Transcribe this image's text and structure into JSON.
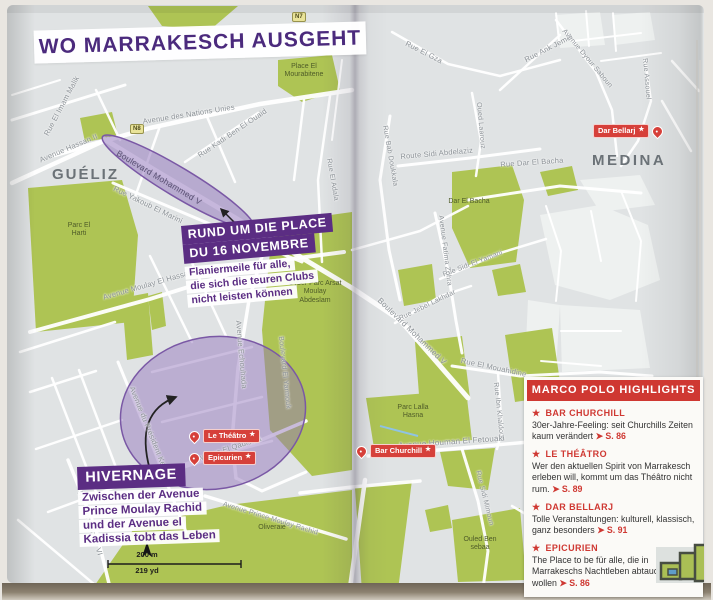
{
  "title": "WO MARRAKESCH AUSGEHT",
  "icons": {
    "star": "★",
    "page_arrow": "➤"
  },
  "road_badges": {
    "n7": "N7",
    "n8": "N8"
  },
  "districts": {
    "gueliz": "GUÉLIZ",
    "medina": "MEDINA"
  },
  "colors": {
    "accent_purple": "#5b2d83",
    "title_purple": "#4b2a7d",
    "accent_red": "#cf3832",
    "marker_red": "#d6403a",
    "map_green": "#aec454",
    "highlight_area_purple": "#9275bc",
    "map_background": "#e0e3e4"
  },
  "streets": {
    "rue_el_imam_malik": "Rue El Imam Malik",
    "avenue_des_nations_unies": "Avenue des Nations Unies",
    "avenue_hassan_ii": "Avenue Hassan II",
    "rue_kadi_ben_el_ouaid": "Rue Kadi Ben El Ouaid",
    "rue_yakoub_el_marini": "Rue Yakoub El Marini",
    "boulevard_mohammed_v_west": "Boulevard Mohammed V",
    "avenue_moulay_el_hassan": "Avenue Moulay El Hassan",
    "avenue_echouhada": "Avenue Echouhada",
    "boulevard_el_yarmouk": "Boulevard El Yarmouk",
    "rue_el_adala": "Rue El Adala",
    "avenue_du_president_kennedy": "Avenue du Président Kennedy",
    "bld_mohammed_vi": "Bld. Mohammed VI",
    "avenue_el_qadissia": "Avenue El Qadissia",
    "avenue_prince_moulay_rachid": "Avenue Prince Moulay Rachid",
    "rue_el_gza": "Rue El Gza",
    "rue_ank_jemel": "Rue Ank Jemel",
    "avenue_dyour_saboun": "Avenue Dyour Saboun",
    "rue_assouel": "Rue Assouel",
    "oued_laarouz": "Oued Laarouz",
    "rue_bab_doukkala": "Rue Bab Doukkala",
    "route_sidi_abdelaziz": "Route Sidi Abdelaziz",
    "rue_dar_el_bacha": "Rue Dar El Bacha",
    "rue_sidi_el_yamani": "Rue Sidi El Yamani",
    "avenue_fatima_zohra": "Avenue Fatima Zohra",
    "rue_jebel_lakhdar": "Rue Jebel Lakhdar",
    "boulevard_mohammed_v_east": "Boulevard Mohammed V",
    "rue_el_mouahidine": "Rue El Mouahidine",
    "rue_ibn_khaldoun": "Rue Ibn Khaldoun",
    "avenue_houman_el_fetouaki": "Avenue Houman El Fetouaki",
    "rue_sidi_mimoun": "Rue Sidi Mimoun"
  },
  "areas": {
    "place_el_mourabitene": "Place El Mourabitene",
    "parc_el_harti": "Parc El Harti",
    "cyber_parc": "Cyber Parc Arsat Moulay Abdeslam",
    "dar_el_bacha": "Dar El Bacha",
    "parc_lalla_hasna": "Parc Lalla Hasna",
    "oliveraie": "Oliveraie",
    "ouled_ben_sebaa": "Ouled Ben sebaa"
  },
  "markers": {
    "dar_bellarj": "Dar Bellarj",
    "le_theatro": "Le Théâtro",
    "epicurien": "Epicurien",
    "bar_churchill": "Bar Churchill"
  },
  "callout_place16": {
    "title_line1": "RUND UM DIE PLACE",
    "title_line2": "DU 16 NOVEMBRE",
    "body_lines": [
      "Flaniermeile für alle,",
      "die sich die teuren Clubs",
      "nicht leisten können"
    ]
  },
  "callout_hivernage": {
    "title": "HIVERNAGE",
    "body_lines": [
      "Zwischen der Avenue",
      "Prince Moulay Rachid",
      "und der Avenue el",
      "Kadissia tobt das Leben"
    ]
  },
  "highlights": {
    "header": "MARCO POLO HIGHLIGHTS",
    "items": [
      {
        "name": "BAR CHURCHILL",
        "text": "30er-Jahre-Feeling: seit Churchills Zeiten kaum verändert",
        "page": "S. 86"
      },
      {
        "name": "LE THÉÂTRO",
        "text": "Wer den aktuellen Spirit von Marra­kesch erleben will, kommt um das Théâtro nicht rum.",
        "page": "S. 89"
      },
      {
        "name": "DAR BELLARJ",
        "text": "Tolle Veranstaltungen: kulturell, klassisch, ganz besonders",
        "page": "S. 91"
      },
      {
        "name": "EPICURIEN",
        "text": "The Place to be für alle, die in Marrakeschs Nachtleben abtauchen wollen",
        "page": "S. 86"
      }
    ]
  },
  "scale": {
    "metric": "200 m",
    "imperial": "219 yd"
  }
}
